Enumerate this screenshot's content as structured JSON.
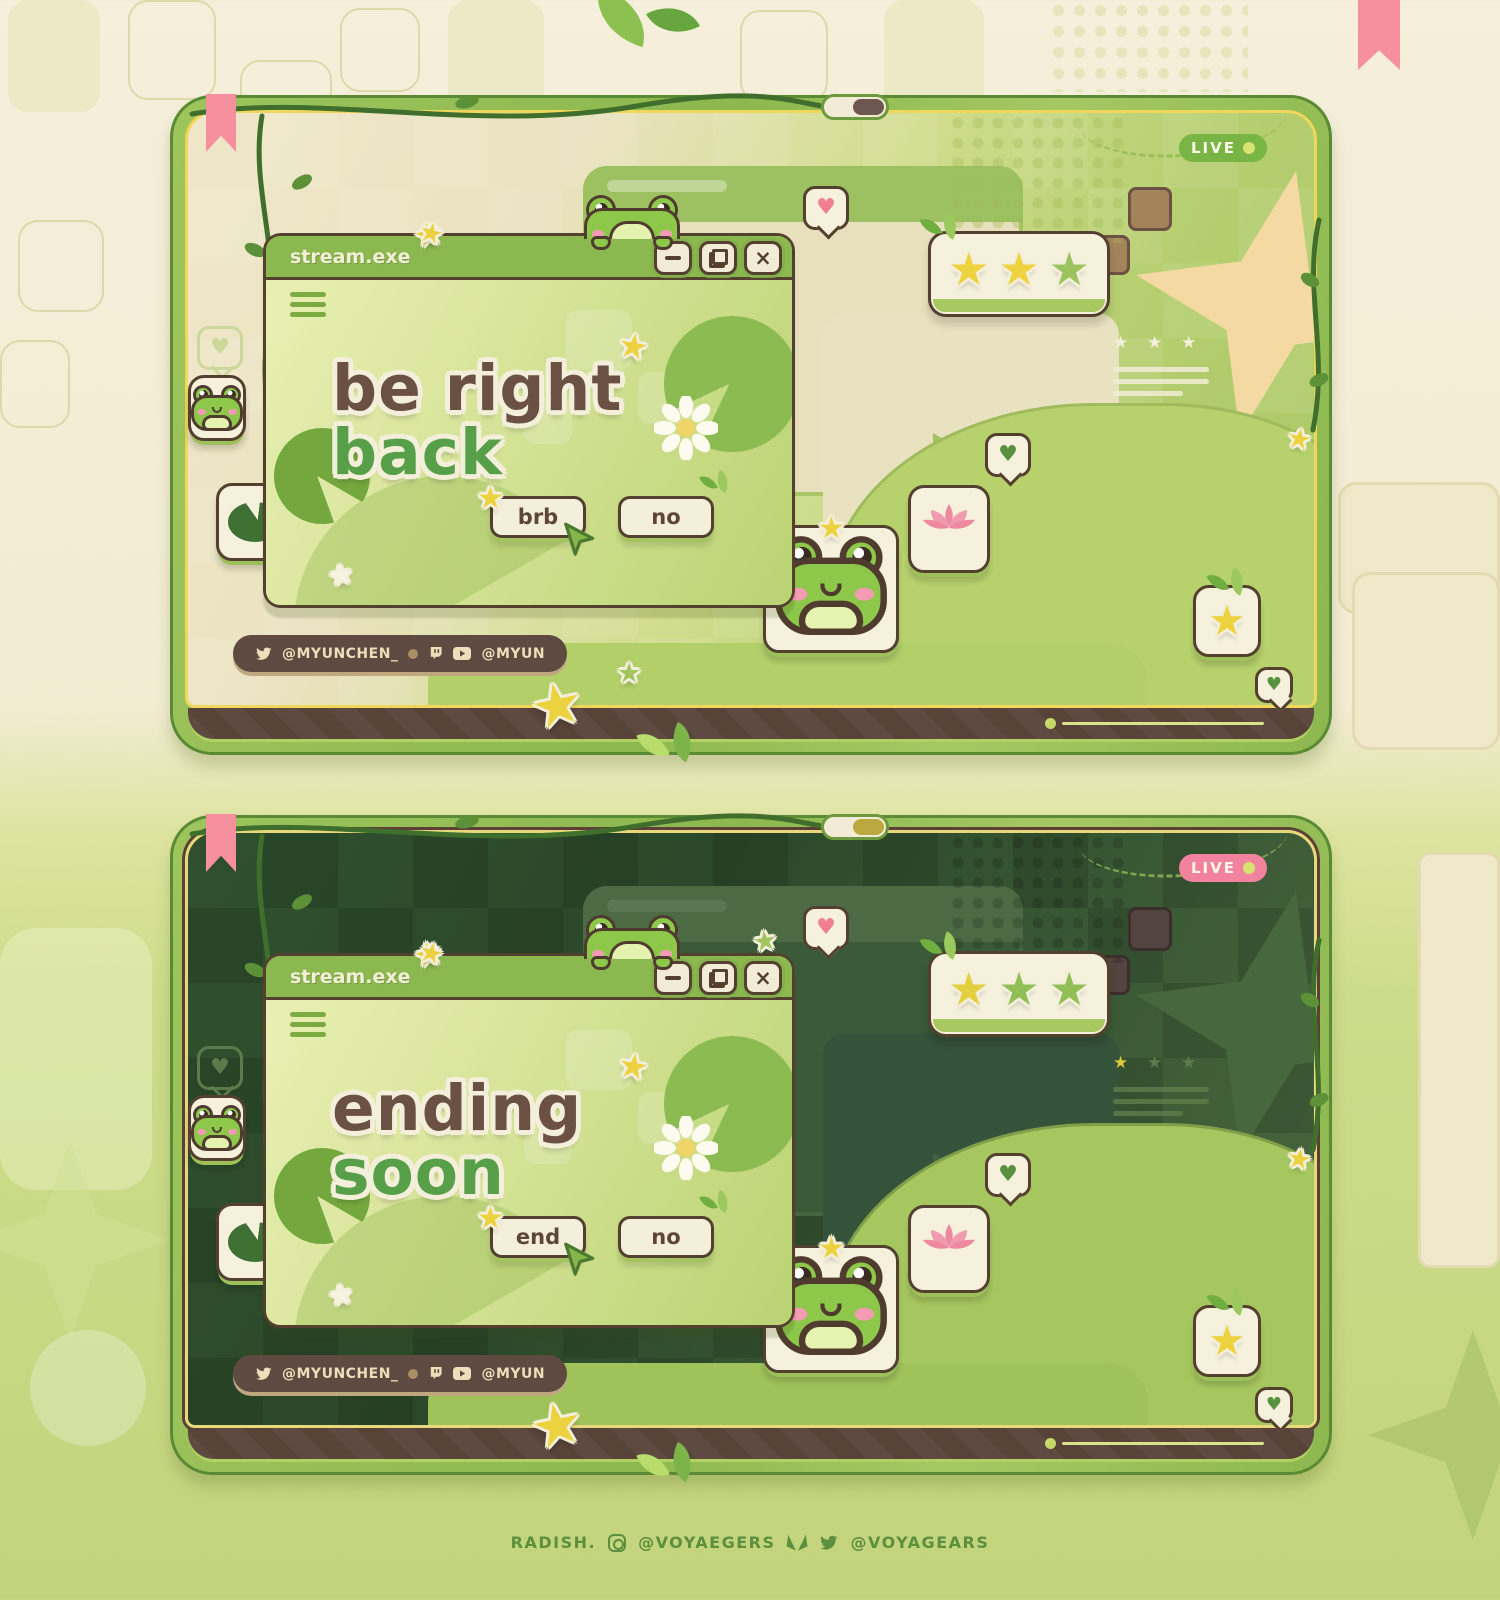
{
  "icons": {
    "star": "★",
    "heart": "♥",
    "close": "×"
  },
  "colors": {
    "accent_green": "#8cb84f",
    "accent_yellow": "#eed75b",
    "text_brown": "#6b5143",
    "text_green": "#57a049",
    "live_dot": "#d7e36e"
  },
  "footer": {
    "credit": "RADISH.",
    "instagram_handle": "@VOYAEGERS",
    "twitter_handle": "@VOYAGEARS"
  },
  "panels": [
    {
      "name": "be right back scene",
      "live_label": "LIVE",
      "live_color": "#79b544",
      "pill_color": "#6e5750",
      "window": {
        "title": "stream.exe",
        "heading_line1": "be right",
        "heading_line2": "back",
        "confirm_label": "brb",
        "cancel_label": "no"
      },
      "social": {
        "twitter_handle": "@MYUNCHEN_",
        "youtube_handle": "@MYUN"
      },
      "rating": {
        "star_colors": [
          "#eed23f",
          "#eed23f",
          "#9cc45e"
        ]
      }
    },
    {
      "name": "ending soon scene",
      "live_label": "LIVE",
      "live_color": "#f2839f",
      "pill_color": "#bba93f",
      "window": {
        "title": "stream.exe",
        "heading_line1": "ending",
        "heading_line2": "soon",
        "confirm_label": "end",
        "cancel_label": "no"
      },
      "social": {
        "twitter_handle": "@MYUNCHEN_",
        "youtube_handle": "@MYUN"
      },
      "rating": {
        "star_colors": [
          "#e4cf3e",
          "#92bf55",
          "#92bf55"
        ]
      }
    }
  ]
}
